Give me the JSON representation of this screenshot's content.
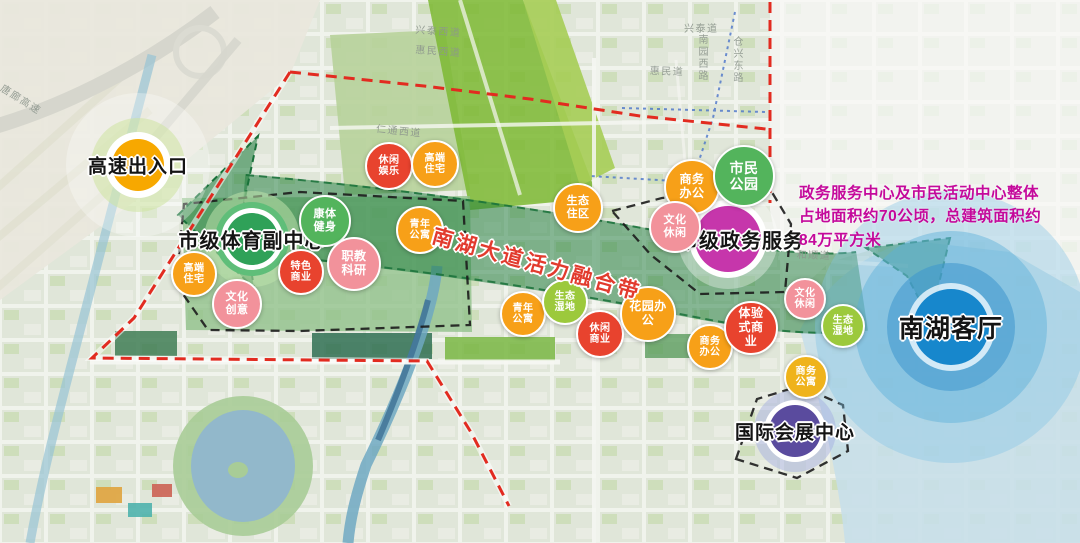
{
  "palette": {
    "red": "#E8432E",
    "orange": "#F7A018",
    "yellow": "#EFB31C",
    "green": "#53B45C",
    "lightgreen": "#9CC93C",
    "pink": "#F2929B",
    "magenta": "#C636AB",
    "purple": "#5A4B9E",
    "blue": "#1787CC",
    "sportGreen": "#2FA158",
    "highwayOrange": "#F7A800",
    "beltGreen": "#1E7A3A",
    "beltLabelRed": "#E23B2E",
    "annotationMagenta": "#C4099B",
    "redBoundary": "#E22B20",
    "blackBoundary": "#1c1c1c"
  },
  "belt": {
    "label": "南湖大道活力融合带"
  },
  "annotation": {
    "lines": [
      "政务服务中心及市民活动中心整体",
      "占地面积约70公顷，总建筑面积约",
      "84万平方米"
    ]
  },
  "nodes": [
    {
      "id": "highway-exit",
      "label": "高速出入口",
      "x": 138,
      "y": 165,
      "font": 19,
      "rings": [
        {
          "r": 72,
          "fill": "rgba(255,255,255,0.30)"
        },
        {
          "r": 47,
          "fill": "rgba(205,228,160,0.55)"
        },
        {
          "r": 33,
          "fill": "#ffffff"
        },
        {
          "r": 26,
          "fill": "#F7A800"
        }
      ]
    },
    {
      "id": "sports-subcenter",
      "label": "市级体育副中心",
      "x": 252,
      "y": 239,
      "font": 20,
      "rings": [
        {
          "r": 48,
          "fill": "rgba(190,226,172,0.55)"
        },
        {
          "r": 37,
          "fill": "#5FBE79"
        },
        {
          "r": 31,
          "fill": "#ffffff"
        },
        {
          "r": 26,
          "fill": "#2FA158"
        }
      ]
    },
    {
      "id": "gov-services",
      "label": "市级政务服务",
      "x": 728,
      "y": 239,
      "labelX": 741,
      "font": 20,
      "rings": [
        {
          "r": 50,
          "fill": "rgba(255,255,255,0.35)"
        },
        {
          "r": 39,
          "fill": "#ffffff"
        },
        {
          "r": 33,
          "fill": "#C636AB"
        }
      ]
    },
    {
      "id": "expo-center",
      "label": "国际会展中心",
      "x": 795,
      "y": 431,
      "font": 19,
      "rings": [
        {
          "r": 41,
          "fill": "rgba(160,170,225,0.45)"
        },
        {
          "r": 31,
          "fill": "#ffffff"
        },
        {
          "r": 26,
          "fill": "#5A4B9E"
        }
      ]
    },
    {
      "id": "nanhu-living-room",
      "label": "南湖客厅",
      "x": 951,
      "y": 327,
      "font": 25,
      "rings": [
        {
          "r": 136,
          "fill": "rgba(130,195,230,0.38)"
        },
        {
          "r": 96,
          "fill": "rgba(90,175,218,0.45)"
        },
        {
          "r": 64,
          "fill": "rgba(60,150,205,0.55)"
        },
        {
          "r": 44,
          "fill": "rgba(240,250,255,0.80)"
        },
        {
          "r": 38,
          "fill": "#1787CC"
        }
      ]
    }
  ],
  "bubbles": [
    {
      "id": "leisure-entertainment",
      "x": 389,
      "y": 166,
      "r": 22,
      "color": "red",
      "lines": [
        "休闲",
        "娱乐"
      ]
    },
    {
      "id": "highend-residential-1",
      "x": 435,
      "y": 164,
      "r": 22,
      "color": "orange",
      "lines": [
        "高端",
        "住宅"
      ]
    },
    {
      "id": "fitness",
      "x": 325,
      "y": 221,
      "r": 24,
      "color": "green",
      "lines": [
        "康体",
        "健身"
      ]
    },
    {
      "id": "youth-apartments-1",
      "x": 420,
      "y": 230,
      "r": 22,
      "color": "orange",
      "lines": [
        "青年",
        "公寓"
      ]
    },
    {
      "id": "vocational-research",
      "x": 354,
      "y": 264,
      "r": 25,
      "color": "pink",
      "lines": [
        "职教",
        "科研"
      ]
    },
    {
      "id": "featured-commerce",
      "x": 301,
      "y": 272,
      "r": 21,
      "color": "red",
      "lines": [
        "特色",
        "商业"
      ]
    },
    {
      "id": "highend-residential-2",
      "x": 194,
      "y": 274,
      "r": 21,
      "color": "orange",
      "lines": [
        "高端",
        "住宅"
      ]
    },
    {
      "id": "cultural-creativity",
      "x": 237,
      "y": 304,
      "r": 23,
      "color": "pink",
      "lines": [
        "文化",
        "创意"
      ]
    },
    {
      "id": "eco-residential",
      "x": 578,
      "y": 208,
      "r": 23,
      "color": "orange",
      "lines": [
        "生态",
        "住区"
      ]
    },
    {
      "id": "business-office-1",
      "x": 692,
      "y": 187,
      "r": 26,
      "color": "orange",
      "lines": [
        "商务",
        "办公"
      ]
    },
    {
      "id": "cultural-leisure-1",
      "x": 675,
      "y": 227,
      "r": 24,
      "color": "pink",
      "lines": [
        "文化",
        "休闲"
      ]
    },
    {
      "id": "citizens-park",
      "x": 744,
      "y": 176,
      "r": 29,
      "color": "green",
      "lines": [
        "市民",
        "公园"
      ]
    },
    {
      "id": "youth-apartments-2",
      "x": 523,
      "y": 314,
      "r": 21,
      "color": "orange",
      "lines": [
        "青年",
        "公寓"
      ]
    },
    {
      "id": "eco-wetland-1",
      "x": 565,
      "y": 302,
      "r": 21,
      "color": "lightgreen",
      "lines": [
        "生态",
        "湿地"
      ]
    },
    {
      "id": "leisure-commerce",
      "x": 600,
      "y": 334,
      "r": 22,
      "color": "red",
      "lines": [
        "休闲",
        "商业"
      ]
    },
    {
      "id": "garden-office",
      "x": 648,
      "y": 314,
      "r": 26,
      "color": "orange",
      "lines": [
        "花园办",
        "公"
      ]
    },
    {
      "id": "business-office-2",
      "x": 710,
      "y": 347,
      "r": 21,
      "color": "orange",
      "lines": [
        "商务",
        "办公"
      ]
    },
    {
      "id": "experiential-commerce",
      "x": 751,
      "y": 328,
      "r": 25,
      "color": "red",
      "lines": [
        "体验",
        "式商",
        "业"
      ]
    },
    {
      "id": "cultural-leisure-2",
      "x": 805,
      "y": 299,
      "r": 19,
      "color": "pink",
      "lines": [
        "文化",
        "休闲"
      ]
    },
    {
      "id": "eco-wetland-2",
      "x": 843,
      "y": 326,
      "r": 20,
      "color": "lightgreen",
      "lines": [
        "生态",
        "湿地"
      ]
    },
    {
      "id": "business-apartments",
      "x": 806,
      "y": 377,
      "r": 20,
      "color": "yellow",
      "lines": [
        "商务",
        "公寓"
      ]
    }
  ],
  "roads": [
    {
      "id": "tanglang-expressway",
      "name": "唐廊高速",
      "x": 6,
      "y": 80,
      "rot": 32
    },
    {
      "id": "xingtai-west-rd",
      "name": "兴泰西道",
      "x": 416,
      "y": 21,
      "rot": 4
    },
    {
      "id": "huimin-west-rd",
      "name": "惠民西道",
      "x": 416,
      "y": 41,
      "rot": 4
    },
    {
      "id": "rentong-west-rd",
      "name": "仁通西道",
      "x": 377,
      "y": 120,
      "rot": 6
    },
    {
      "id": "xingtai-rd",
      "name": "兴泰道",
      "x": 684,
      "y": 20,
      "rot": 0
    },
    {
      "id": "huimin-rd",
      "name": "惠民道",
      "x": 650,
      "y": 62,
      "rot": 2
    },
    {
      "id": "nanyuan-west-rd",
      "name": "南园西路",
      "x": 694,
      "y": 34,
      "v": true
    },
    {
      "id": "cangxing-east-rd",
      "name": "仓兴东路",
      "x": 729,
      "y": 36,
      "v": true
    },
    {
      "id": "heshun-rd",
      "name": "和顺道",
      "x": 797,
      "y": 246,
      "rot": 2
    }
  ]
}
